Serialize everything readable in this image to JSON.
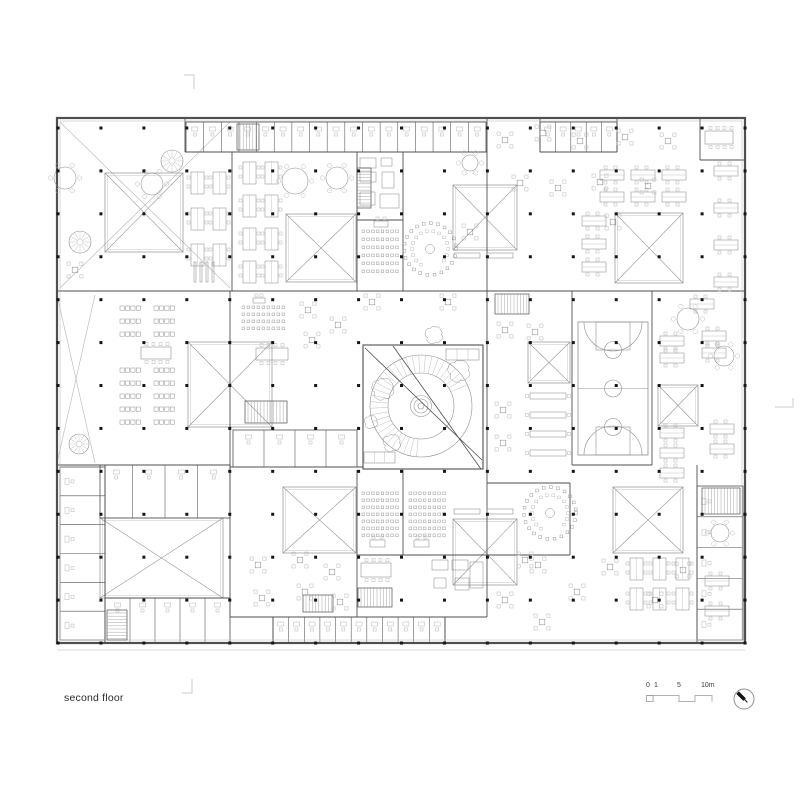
{
  "page": {
    "background": "#ffffff"
  },
  "footer": {
    "floor_label": "second floor",
    "scale": {
      "t0": "0",
      "t1": "1",
      "t5": "5",
      "t10": "10m"
    },
    "north_arrow": "compass-needle-northwest"
  },
  "plan": {
    "colors": {
      "wall": "#4f4f4f",
      "light": "#8f8f8f",
      "faint": "#b6b6b6",
      "dot": "#151515",
      "ground": "#d8d8d8",
      "mark": "#cbcbcb"
    },
    "outer": {
      "x": 57,
      "y": 118,
      "w": 688,
      "h": 525
    },
    "ground_y": 650,
    "grid": {
      "x0": 58,
      "y0": 128,
      "dx": 42.94,
      "dy": 42.92,
      "cols": 17,
      "rows": 13,
      "s": 3
    },
    "walls": [
      [
        185,
        118,
        185,
        152
      ],
      [
        232,
        152,
        232,
        291
      ],
      [
        357,
        152,
        357,
        291
      ],
      [
        403,
        152,
        403,
        291
      ],
      [
        487,
        118,
        487,
        617
      ],
      [
        540,
        118,
        540,
        152
      ],
      [
        617,
        118,
        617,
        152
      ],
      [
        700,
        118,
        700,
        160
      ],
      [
        572,
        291,
        572,
        465
      ],
      [
        652,
        291,
        652,
        465
      ],
      [
        230,
        291,
        230,
        617
      ],
      [
        105,
        465,
        105,
        643
      ],
      [
        697,
        465,
        697,
        643
      ],
      [
        357,
        470,
        357,
        617
      ],
      [
        403,
        470,
        403,
        555
      ],
      [
        570,
        483,
        570,
        555
      ],
      [
        273,
        617,
        273,
        643
      ],
      [
        445,
        617,
        445,
        643
      ],
      [
        185,
        152,
        487,
        152
      ],
      [
        540,
        152,
        617,
        152
      ],
      [
        700,
        160,
        745,
        160
      ],
      [
        57,
        291,
        745,
        291
      ],
      [
        57,
        465,
        230,
        465
      ],
      [
        230,
        467,
        363,
        467
      ],
      [
        572,
        465,
        652,
        465
      ],
      [
        487,
        483,
        570,
        483
      ],
      [
        487,
        555,
        570,
        555
      ],
      [
        357,
        555,
        487,
        555
      ],
      [
        230,
        617,
        487,
        617
      ],
      [
        357,
        220,
        403,
        220
      ],
      [
        105,
        598,
        230,
        598
      ]
    ],
    "blocks": [
      [
        363,
        345,
        120,
        124
      ]
    ],
    "fixtures": [
      [
        360,
        158,
        16,
        10
      ],
      [
        360,
        172,
        16,
        10
      ],
      [
        381,
        158,
        11,
        8
      ],
      [
        382,
        172,
        12,
        16
      ],
      [
        360,
        192,
        15,
        13
      ],
      [
        380,
        194,
        19,
        14
      ],
      [
        432,
        560,
        16,
        10
      ],
      [
        452,
        560,
        16,
        10
      ],
      [
        434,
        578,
        12,
        10
      ],
      [
        455,
        578,
        14,
        12
      ],
      [
        470,
        562,
        13,
        26
      ]
    ],
    "strips": [
      {
        "x": 186,
        "y": 122,
        "w": 300,
        "h": 30,
        "n": 17,
        "dir": "h"
      },
      {
        "x": 540,
        "y": 122,
        "w": 77,
        "h": 30,
        "n": 5,
        "dir": "h"
      },
      {
        "x": 273,
        "y": 617,
        "w": 172,
        "h": 26,
        "n": 11,
        "dir": "h"
      },
      {
        "x": 60,
        "y": 467,
        "w": 45,
        "h": 173,
        "n": 6,
        "dir": "v"
      },
      {
        "x": 697,
        "y": 486,
        "w": 46,
        "h": 154,
        "n": 5,
        "dir": "v"
      },
      {
        "x": 100,
        "y": 465,
        "w": 130,
        "h": 53,
        "n": 4,
        "dir": "h"
      },
      {
        "x": 105,
        "y": 598,
        "w": 125,
        "h": 45,
        "n": 5,
        "dir": "h"
      },
      {
        "x": 233,
        "y": 430,
        "w": 124,
        "h": 37,
        "n": 4,
        "dir": "h"
      }
    ],
    "xsq": [
      [
        105,
        173,
        78,
        79
      ],
      [
        286,
        214,
        70,
        68
      ],
      [
        453,
        185,
        64,
        65
      ],
      [
        615,
        213,
        68,
        70
      ],
      [
        188,
        342,
        84,
        85
      ],
      [
        528,
        342,
        42,
        41
      ],
      [
        658,
        385,
        40,
        41
      ],
      [
        100,
        518,
        123,
        80
      ],
      [
        283,
        487,
        73,
        66
      ],
      [
        453,
        519,
        64,
        66
      ],
      [
        613,
        487,
        70,
        66
      ]
    ],
    "xzones": [
      [
        60,
        122,
        170,
        166
      ],
      [
        57,
        295,
        38,
        168
      ]
    ],
    "stairs": [
      [
        237,
        124,
        22,
        26,
        "v"
      ],
      [
        495,
        294,
        34,
        20,
        "v"
      ],
      [
        357,
        168,
        14,
        40,
        "h"
      ],
      [
        245,
        401,
        42,
        22,
        "v"
      ],
      [
        702,
        488,
        38,
        26,
        "v"
      ],
      [
        107,
        610,
        20,
        30,
        "h"
      ],
      [
        358,
        588,
        34,
        19,
        "v"
      ],
      [
        303,
        595,
        30,
        17,
        "v"
      ]
    ],
    "spirals": [
      [
        172,
        161,
        11
      ],
      [
        80,
        242,
        11
      ],
      [
        79,
        444,
        10
      ]
    ],
    "clusters": [
      {
        "t": "pairV",
        "x": 191,
        "y": 172,
        "c": 2,
        "r": 3,
        "dx": 22,
        "dy": 36
      },
      {
        "t": "pairV",
        "x": 243,
        "y": 162,
        "c": 2,
        "r": 4,
        "dx": 22,
        "dy": 33
      },
      {
        "t": "pairH",
        "x": 600,
        "y": 170,
        "c": 3,
        "r": 2,
        "dx": 31,
        "dy": 22
      },
      {
        "t": "pairH",
        "x": 582,
        "y": 216,
        "c": 1,
        "r": 3,
        "dx": 0,
        "dy": 23
      },
      {
        "t": "pairH",
        "x": 714,
        "y": 166,
        "c": 1,
        "r": 4,
        "dx": 0,
        "dy": 37
      },
      {
        "t": "pairH",
        "x": 660,
        "y": 336,
        "c": 1,
        "r": 2,
        "dx": 0,
        "dy": 17
      },
      {
        "t": "pairH",
        "x": 702,
        "y": 331,
        "c": 1,
        "r": 2,
        "dx": 0,
        "dy": 17
      },
      {
        "t": "pairH",
        "x": 660,
        "y": 428,
        "c": 1,
        "r": 3,
        "dx": 0,
        "dy": 20
      },
      {
        "t": "pairH",
        "x": 710,
        "y": 424,
        "c": 1,
        "r": 2,
        "dx": 0,
        "dy": 20
      },
      {
        "t": "pairH",
        "x": 690,
        "y": 299,
        "c": 1,
        "r": 1,
        "dx": 0,
        "dy": 0
      },
      {
        "t": "pairV",
        "x": 630,
        "y": 558,
        "c": 3,
        "r": 2,
        "dx": 23,
        "dy": 30
      },
      {
        "t": "pairH",
        "x": 705,
        "y": 576,
        "c": 1,
        "r": 1,
        "dx": 0,
        "dy": 0
      },
      {
        "t": "pairH",
        "x": 705,
        "y": 606,
        "c": 1,
        "r": 1,
        "dx": 0,
        "dy": 0
      },
      {
        "t": "seatrow",
        "x": 120,
        "y": 306,
        "c": 2,
        "r": 3,
        "dx": 34,
        "dy": 13
      },
      {
        "t": "seatrow",
        "x": 120,
        "y": 368,
        "c": 2,
        "r": 5,
        "dx": 34,
        "dy": 13
      },
      {
        "t": "bar",
        "x": 530,
        "y": 393,
        "c": 1,
        "r": 4,
        "dx": 0,
        "dy": 19
      }
    ],
    "t4": [
      [
        505,
        140
      ],
      [
        543,
        133
      ],
      [
        580,
        141
      ],
      [
        625,
        137
      ],
      [
        668,
        141
      ],
      [
        520,
        183
      ],
      [
        558,
        188
      ],
      [
        600,
        182
      ],
      [
        648,
        186
      ],
      [
        613,
        222
      ],
      [
        308,
        310
      ],
      [
        338,
        325
      ],
      [
        312,
        340
      ],
      [
        505,
        330
      ],
      [
        535,
        332
      ],
      [
        503,
        410
      ],
      [
        503,
        443
      ],
      [
        258,
        565
      ],
      [
        300,
        560
      ],
      [
        332,
        572
      ],
      [
        262,
        598
      ],
      [
        305,
        592
      ],
      [
        340,
        602
      ],
      [
        505,
        600
      ],
      [
        538,
        565
      ],
      [
        542,
        622
      ],
      [
        577,
        592
      ],
      [
        610,
        567
      ],
      [
        655,
        600
      ],
      [
        683,
        570
      ],
      [
        75,
        270
      ],
      [
        470,
        232
      ],
      [
        372,
        302
      ],
      [
        448,
        302
      ],
      [
        525,
        560
      ]
    ],
    "rtables": [
      [
        152,
        184,
        11
      ],
      [
        295,
        181,
        13
      ],
      [
        337,
        178,
        11
      ],
      [
        65,
        178,
        11
      ],
      [
        688,
        319,
        11
      ],
      [
        724,
        356,
        10
      ],
      [
        720,
        533,
        9
      ],
      [
        470,
        163,
        8
      ]
    ],
    "ltables": [
      [
        705,
        131,
        28,
        13
      ],
      [
        361,
        563,
        30,
        14
      ],
      [
        256,
        348,
        32,
        12
      ],
      [
        141,
        347,
        30,
        12
      ]
    ],
    "benchbars": [
      [
        454,
        253,
        26,
        5
      ],
      [
        487,
        253,
        26,
        5
      ],
      [
        454,
        509,
        26,
        5
      ],
      [
        487,
        509,
        26,
        5
      ]
    ],
    "grids": [
      [
        362,
        230,
        6,
        8,
        4.8,
        8
      ],
      [
        242,
        306,
        4,
        9,
        5,
        7
      ],
      [
        362,
        492,
        7,
        8,
        4.8,
        7
      ],
      [
        409,
        492,
        7,
        8,
        4.8,
        7
      ]
    ],
    "lecterns": [
      [
        374,
        221,
        14,
        6
      ],
      [
        253,
        298,
        12,
        5
      ],
      [
        370,
        540,
        15,
        7
      ],
      [
        414,
        540,
        15,
        7
      ]
    ],
    "seminars": [
      [
        430,
        249,
        26
      ],
      [
        550,
        513,
        26
      ]
    ],
    "shelves": [
      {
        "x": 194,
        "y": 262,
        "n": 4,
        "dx": 6,
        "w": 2,
        "h": 20
      }
    ],
    "atrium": {
      "x": 363,
      "y": 345,
      "w": 120,
      "h": 124,
      "cx": 421,
      "cy": 406,
      "r1": 51,
      "r2": 33,
      "rc": [
        10.5,
        7,
        3
      ],
      "hatch": [
        95,
        340,
        7.5
      ],
      "diag": [
        [
          365,
          348,
          482,
          460
        ],
        [
          393,
          346,
          481,
          469
        ]
      ]
    },
    "court": {
      "x": 578,
      "y": 322,
      "w": 70,
      "h": 133
    },
    "trees": [
      [
        383,
        389,
        10
      ],
      [
        392,
        443,
        8
      ],
      [
        434,
        335,
        8
      ],
      [
        459,
        371,
        10
      ],
      [
        371,
        422,
        6
      ]
    ],
    "benches": [
      [
        446,
        349,
        33,
        11
      ],
      [
        364,
        452,
        31,
        11
      ]
    ],
    "marks": [
      [
        [
          184,
          75
        ],
        [
          194,
          75
        ],
        [
          194,
          89
        ]
      ],
      [
        [
          192,
          679
        ],
        [
          192,
          693
        ],
        [
          182,
          693
        ]
      ],
      [
        [
          793,
          398
        ],
        [
          793,
          407
        ],
        [
          775,
          407
        ]
      ]
    ]
  }
}
